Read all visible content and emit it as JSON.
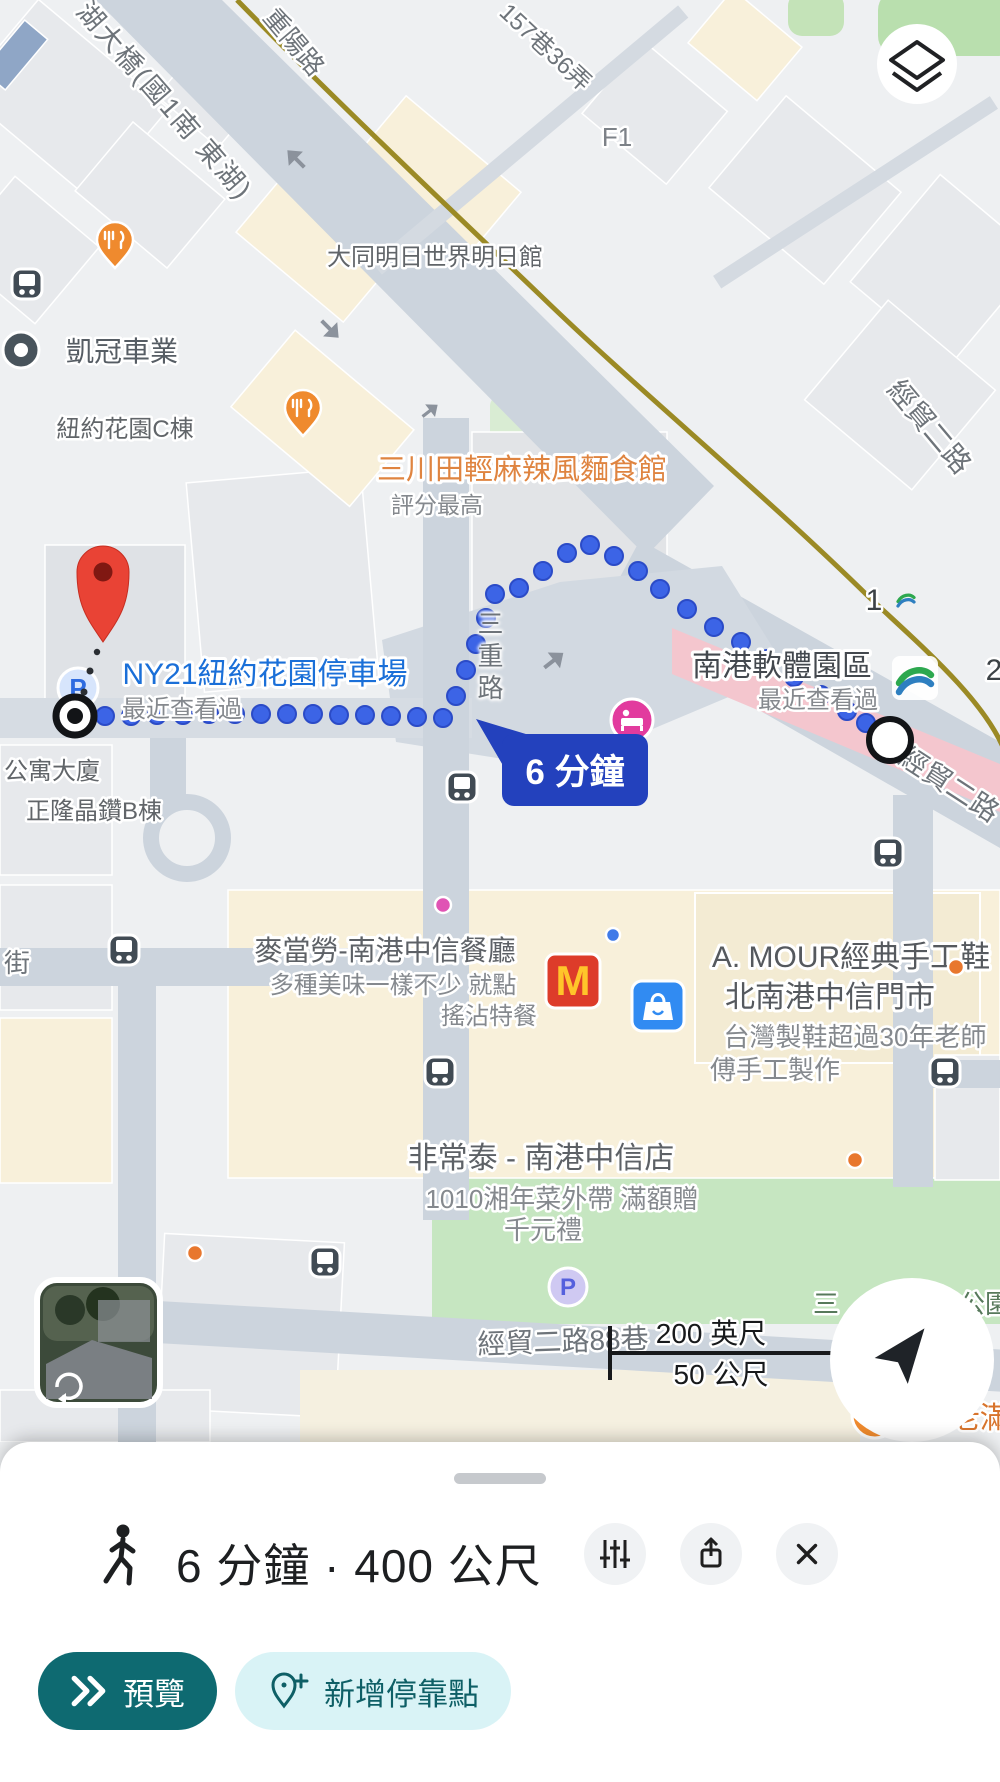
{
  "app": "google-maps-walking-directions",
  "map": {
    "road_labels": {
      "bridge": "湖大橋(國1南 東湖)",
      "chongyang": "重陽路",
      "lane_157_36": "157巷36弄",
      "jingmao_2nd_top": "經貿二路",
      "jingmao_2nd_right": "經貿二路",
      "sanchong_road": "三重路",
      "jingmao_88_lane": "經貿二路88巷",
      "street_fragment": "街"
    },
    "pois": {
      "f1": "F1",
      "datong_pavilion": "大同明日世界明日館",
      "kaiguan_motors": "凱冠車業",
      "ny_garden_c": "紐約花園C棟",
      "sanchuantian": {
        "name": "三川田輕麻辣風麵食館",
        "sub": "評分最高"
      },
      "ny21_parking": {
        "name": "NY21紐約花園停車場",
        "sub": "最近查看過"
      },
      "nangang_software_park": {
        "name": "南港軟體園區",
        "sub": "最近查看過"
      },
      "apartment": "公寓大廈",
      "zhenglong_b": "正隆晶鑽B棟",
      "mcdonalds": {
        "name": "麥當勞-南港中信餐廳",
        "ad_line1": "多種美味一樣不少 就點",
        "ad_line2": "搖沾特餐"
      },
      "amour": {
        "name": "A. MOUR經典手工鞋",
        "name_line2": "北南港中信門市",
        "ad_line1": "台灣製鞋超過30年老師",
        "ad_line2": "傅手工製作"
      },
      "feichangtai": {
        "name": "非常泰 - 南港中信店",
        "ad_line1": "1010湘年菜外帶 滿額贈",
        "ad_line2": "千元禮"
      },
      "xianlaoman": "餡老滿",
      "park_label_left": "三",
      "park_label_right": "公園"
    },
    "transit": {
      "exit_1": "1",
      "exit_2": "2",
      "parking_p": "P",
      "park_parking_p": "P"
    },
    "route": {
      "duration_tooltip": "6 分鐘"
    },
    "scale_bar": {
      "imperial": "200 英尺",
      "metric": "50 公尺"
    }
  },
  "bottom_sheet": {
    "summary": "6 分鐘 · 400 公尺",
    "preview_button": "預覽",
    "add_stop_button": "新增停靠點"
  },
  "colors": {
    "route_blue": "#3c64e6",
    "tooltip_blue": "#2341bd",
    "destination_red": "#e94335",
    "preview_teal": "#0e6a71",
    "add_stop_bg": "#d9f3f6",
    "promoted_orange": "#df8440",
    "parking_blue": "#1a6fd8",
    "highway_olive": "#9b8a25"
  }
}
